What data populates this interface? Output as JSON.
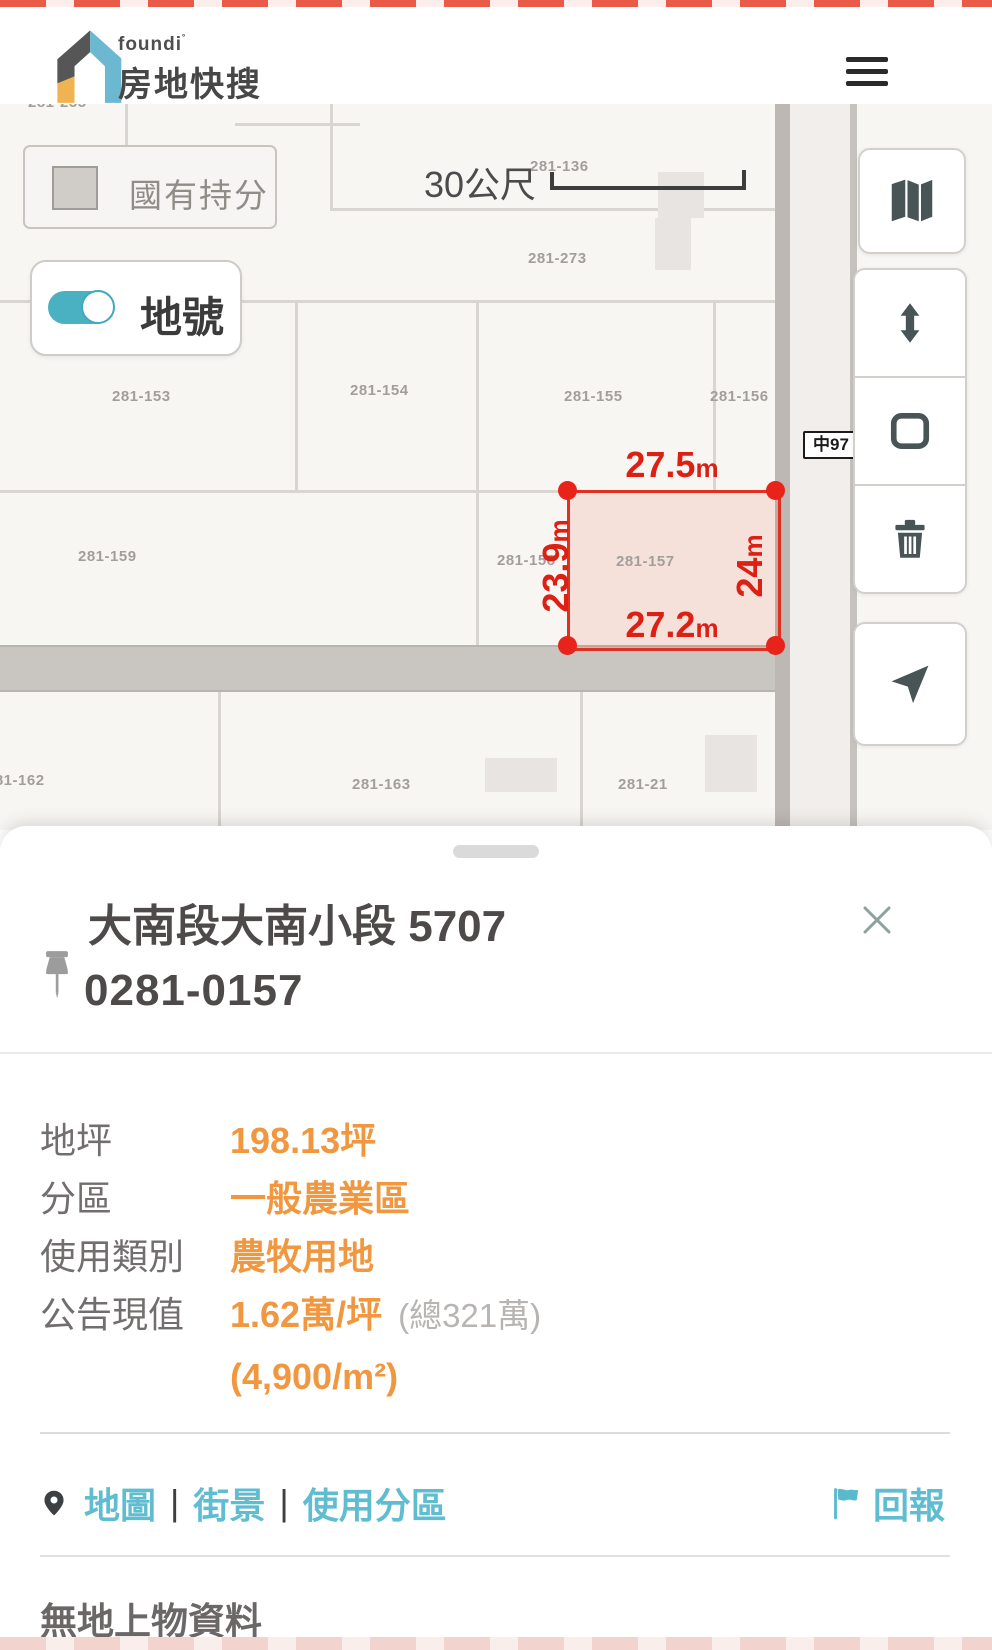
{
  "header": {
    "brand_small": "foundi",
    "brand_mark": "˚",
    "brand_title": "房地快搜"
  },
  "map": {
    "legend_label": "國有持分",
    "toggle_label": "地號",
    "scale_label": "30公尺",
    "road_label": "中97",
    "parcels": [
      "281-255",
      "281-136",
      "281-273",
      "281-153",
      "281-154",
      "281-155",
      "281-156",
      "281-159",
      "281-158",
      "281-162",
      "281-163",
      "281-21"
    ],
    "highlight": {
      "parcel_label": "281-157",
      "top": {
        "v": "27.5",
        "u": "m"
      },
      "bottom": {
        "v": "27.2",
        "u": "m"
      },
      "left": {
        "v": "23.9",
        "u": "m"
      },
      "right": {
        "v": "24",
        "u": "m"
      }
    }
  },
  "sheet": {
    "title": "大南段大南小段 5707",
    "parcel_id": "0281-0157",
    "details": [
      {
        "label": "地坪",
        "value": "198.13坪",
        "extra": ""
      },
      {
        "label": "分區",
        "value": "一般農業區",
        "extra": ""
      },
      {
        "label": "使用類別",
        "value": "農牧用地",
        "extra": ""
      },
      {
        "label": "公告現值",
        "value": "1.62萬/坪",
        "extra": "(總321萬)"
      },
      {
        "label": "",
        "value": "(4,900/m²)",
        "extra": ""
      }
    ],
    "links": [
      "地圖",
      "街景",
      "使用分區"
    ],
    "separator": "|",
    "report": "回報",
    "footer_note": "無地上物資料"
  },
  "colors": {
    "accent_orange": "#f0973f",
    "accent_teal": "#4ab1c3",
    "link_teal": "#60bdd1",
    "highlight_red": "#e0301f",
    "road_gray": "#c9c5c1",
    "label_gray": "#a29e9c"
  }
}
